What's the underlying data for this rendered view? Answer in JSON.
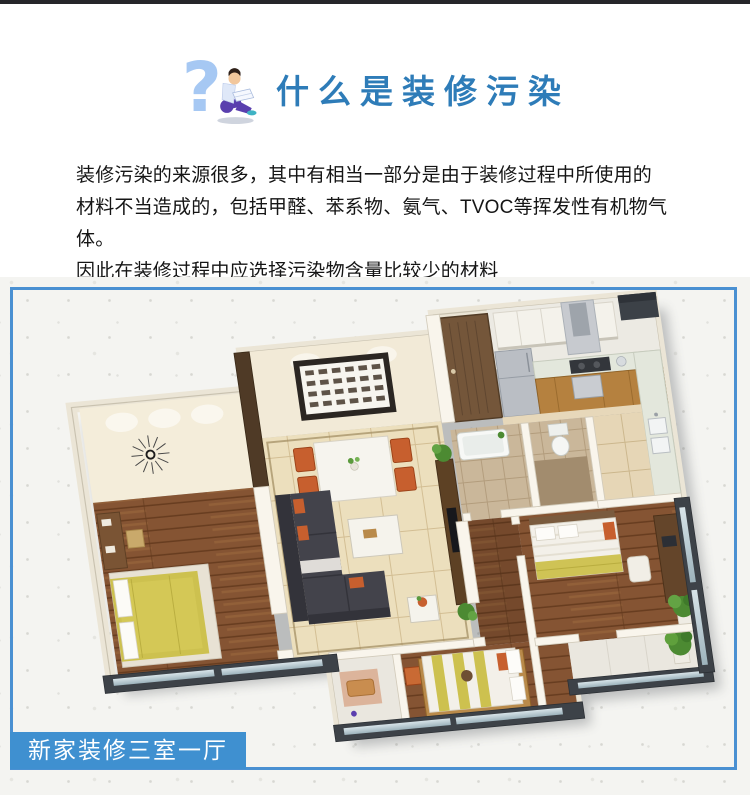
{
  "header": {
    "title": "什么是装修污染",
    "title_color": "#2e7cb8",
    "icon": "question-mark-person-icon"
  },
  "intro": {
    "text": "装修污染的来源很多，其中有相当一部分是由于装修过程中所使用的\n材料不当造成的，包括甲醛、苯系物、氨气、TVOC等挥发性有机物气体。\n因此在装修过程中应选择污染物含量比较少的材料"
  },
  "figure": {
    "caption": "新家装修三室一厅",
    "caption_bg_color": "#3f90d0",
    "caption_text_color": "#ffffff",
    "frame_border_color": "#4a90d2"
  }
}
